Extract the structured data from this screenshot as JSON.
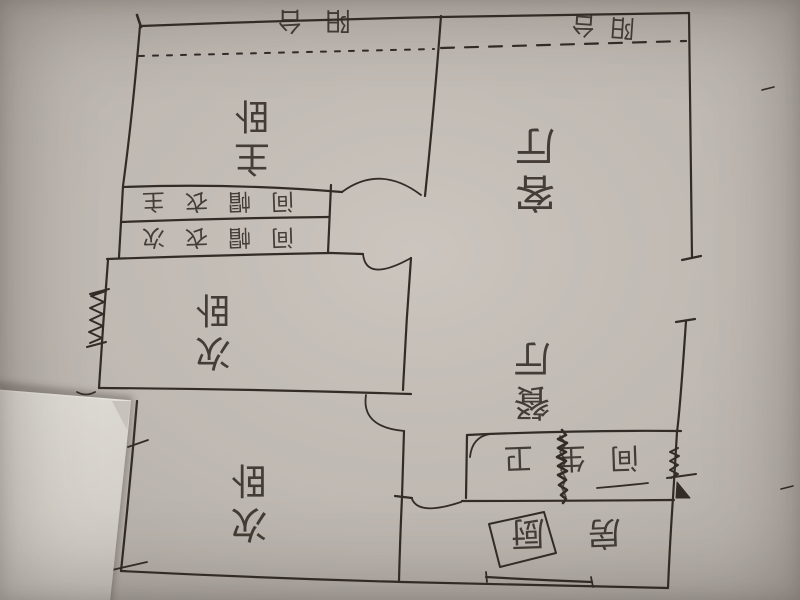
{
  "floor_plan": {
    "rooms": [
      {
        "id": "balcony-left",
        "label": "阳台"
      },
      {
        "id": "balcony-right",
        "label": "阳台"
      },
      {
        "id": "master-bedroom",
        "label": "主卧"
      },
      {
        "id": "master-closet",
        "label": "主衣帽间"
      },
      {
        "id": "second-closet",
        "label": "次衣帽间"
      },
      {
        "id": "second-bedroom-middle",
        "label": "次卧"
      },
      {
        "id": "living-room",
        "label": "客厅"
      },
      {
        "id": "dining-room",
        "label": "餐厅"
      },
      {
        "id": "bathroom",
        "label": "卫生间"
      },
      {
        "id": "second-bedroom-bottom",
        "label": "次卧"
      },
      {
        "id": "kitchen",
        "label": "厨房"
      }
    ],
    "colors": {
      "paper": "#bcb6b0",
      "ink": "#332c26",
      "overlay_sheet": "#dad5cf"
    }
  }
}
